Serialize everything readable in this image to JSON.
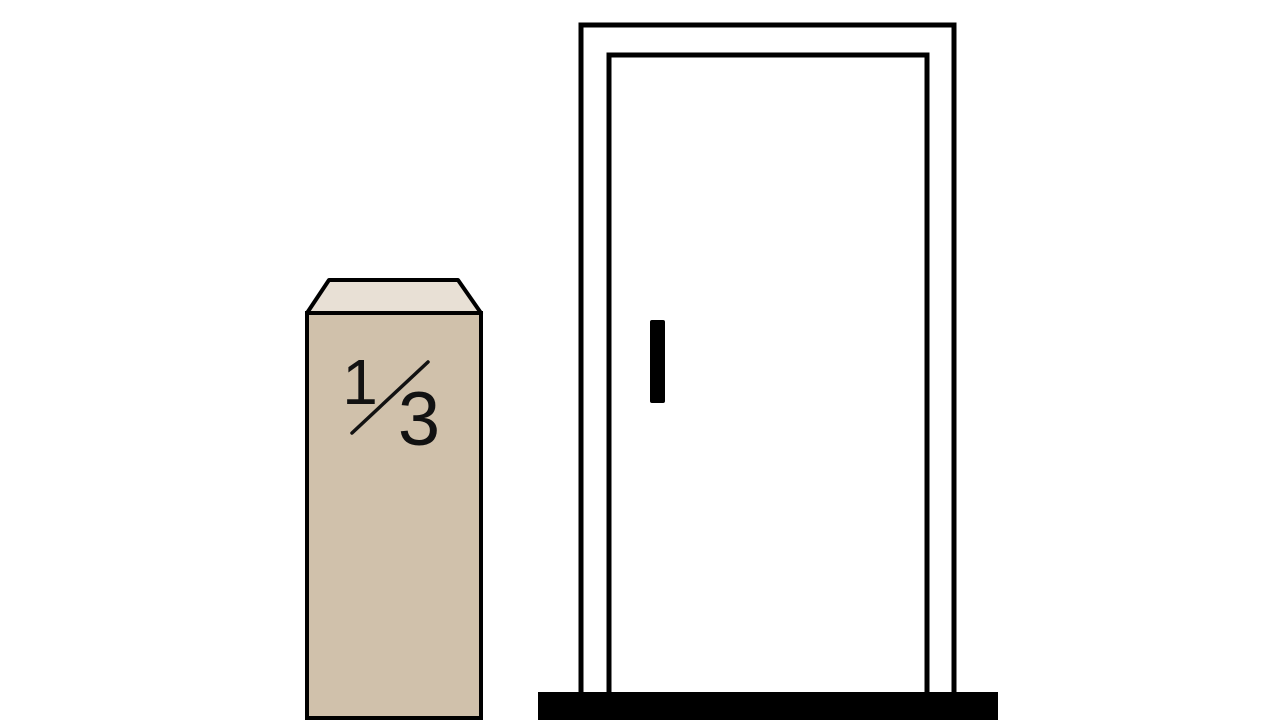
{
  "figure": {
    "background_color": "#ffffff",
    "outline_color": "#000000"
  },
  "block": {
    "fraction": {
      "numerator": "1",
      "denominator": "3",
      "display": "1/3"
    },
    "front_color": "#d0c1ab",
    "top_color": "#e8e0d5",
    "text_color": "#121212"
  },
  "door": {
    "fill_color": "#ffffff",
    "frame_color": "#000000",
    "handle_color": "#000000",
    "threshold_color": "#000000"
  }
}
